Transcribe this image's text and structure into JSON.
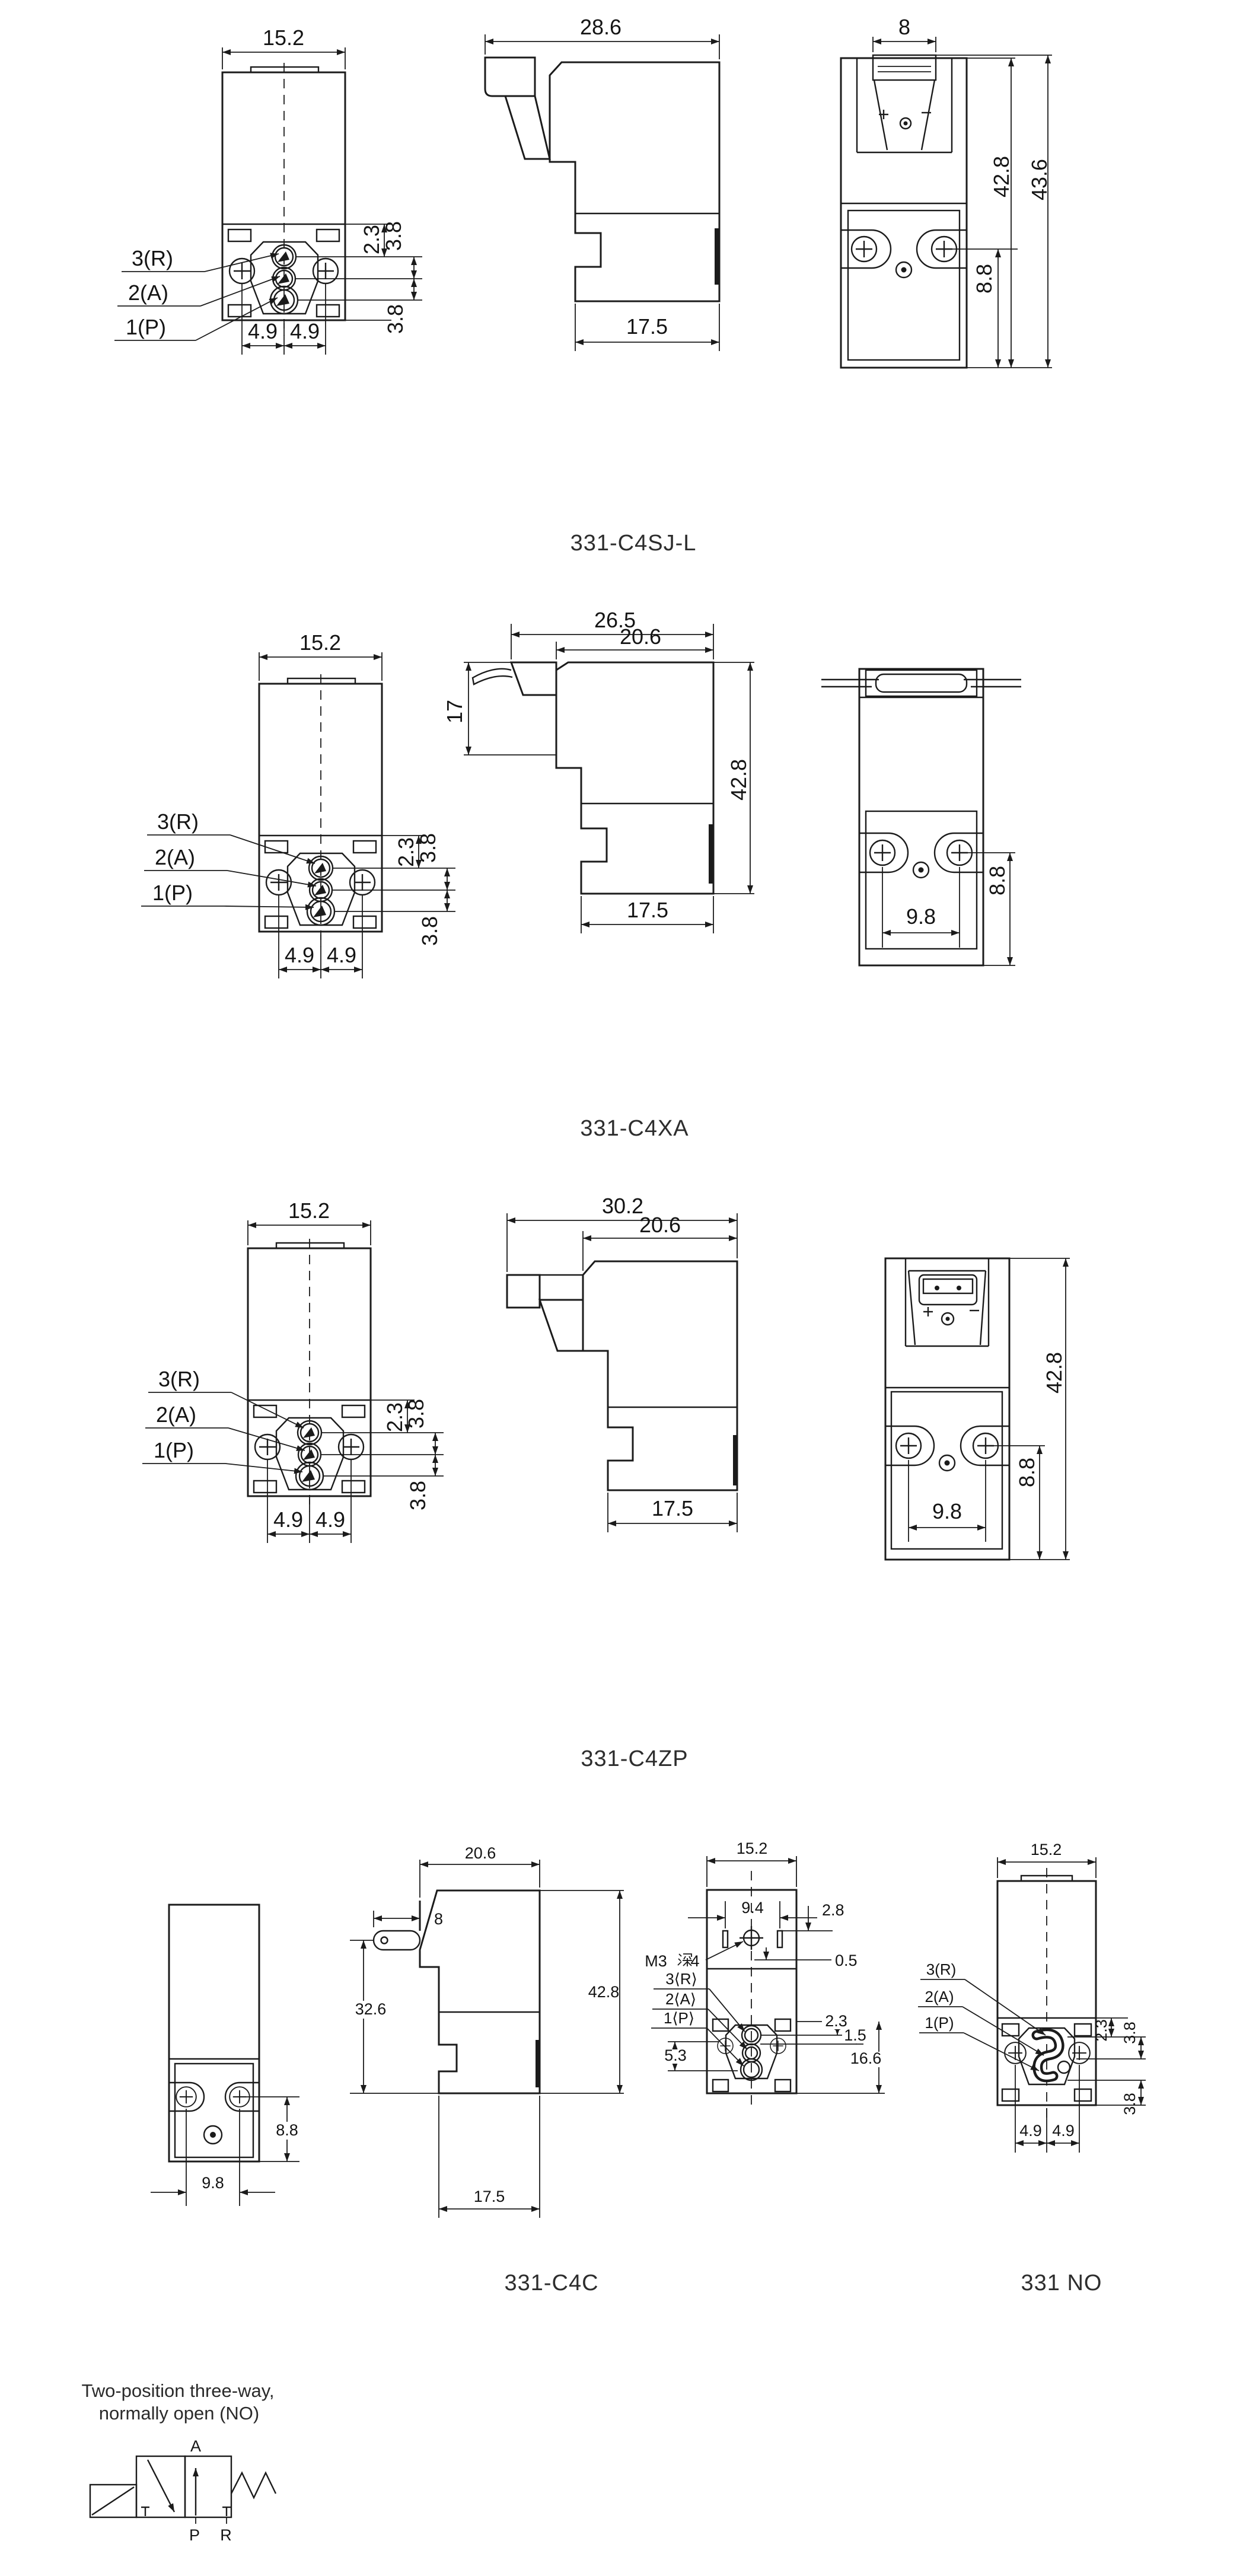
{
  "page": {
    "background": "#ffffff",
    "line_color": "#1b1b1b",
    "text_color": "#141414"
  },
  "port_labels": {
    "r": "3(R)",
    "a": "2(A)",
    "p": "1(P)"
  },
  "port_labels_angled": {
    "r": "3⟨R⟩",
    "a": "2⟨A⟩",
    "p": "1⟨P⟩"
  },
  "thread_note": {
    "prefix": "M3",
    "cjk_char": "深",
    "suffix": "4",
    "full": "M3深4"
  },
  "models": {
    "c4sjl": {
      "label": "331-C4SJ-L",
      "front": {
        "width": "15.2",
        "port_offset": "2.3",
        "pitch_ra": "3.8",
        "pitch_ap": "3.8",
        "screw_half_left": "4.9",
        "screw_half_right": "4.9"
      },
      "side": {
        "depth": "28.6",
        "base_depth": "17.5"
      },
      "rear": {
        "connector_width": "8",
        "height": "42.8",
        "height_total": "43.6",
        "screw_height": "8.8"
      }
    },
    "c4xa": {
      "label": "331-C4XA",
      "front": {
        "width": "15.2",
        "port_offset": "2.3",
        "pitch_ra": "3.8",
        "pitch_ap": "3.8",
        "screw_half_left": "4.9",
        "screw_half_right": "4.9"
      },
      "side": {
        "depth": "26.5",
        "body_depth": "20.6",
        "lead_height": "17",
        "height": "42.8",
        "base_depth": "17.5"
      },
      "rear": {
        "screw_pitch": "9.8",
        "screw_height": "8.8"
      }
    },
    "c4zp": {
      "label": "331-C4ZP",
      "front": {
        "width": "15.2",
        "port_offset": "2.3",
        "pitch_ra": "3.8",
        "pitch_ap": "3.8",
        "screw_half_left": "4.9",
        "screw_half_right": "4.9"
      },
      "side": {
        "depth": "30.2",
        "body_depth": "20.6",
        "base_depth": "17.5"
      },
      "rear": {
        "height": "42.8",
        "screw_height": "8.8",
        "screw_pitch": "9.8"
      }
    },
    "c4c": {
      "label": "331-C4C",
      "front": {
        "screw_height": "8.8",
        "screw_pitch": "9.8"
      },
      "side": {
        "body_depth": "20.6",
        "lead_length": "8",
        "lead_height": "32.6",
        "height": "42.8",
        "base_depth": "17.5"
      }
    },
    "no": {
      "label": "331 NO",
      "top": {
        "width": "15.2",
        "slot_pitch": "9.4",
        "slot_offset": "2.8",
        "slot_offset_small": "0.5",
        "port_offset": "2.3",
        "half_pitch": "1.5",
        "section_height": "16.6",
        "port_dim": "5.3"
      },
      "front": {
        "width": "15.2",
        "port_offset": "2.3",
        "pitch_ra": "3.8",
        "pitch_ap": "3.8",
        "screw_half_left": "4.9",
        "screw_half_right": "4.9"
      }
    }
  },
  "symbol": {
    "caption_line1": "Two-position three-way,",
    "caption_line2": "normally open (NO)",
    "port_a": "A",
    "port_p": "P",
    "port_r": "R"
  }
}
